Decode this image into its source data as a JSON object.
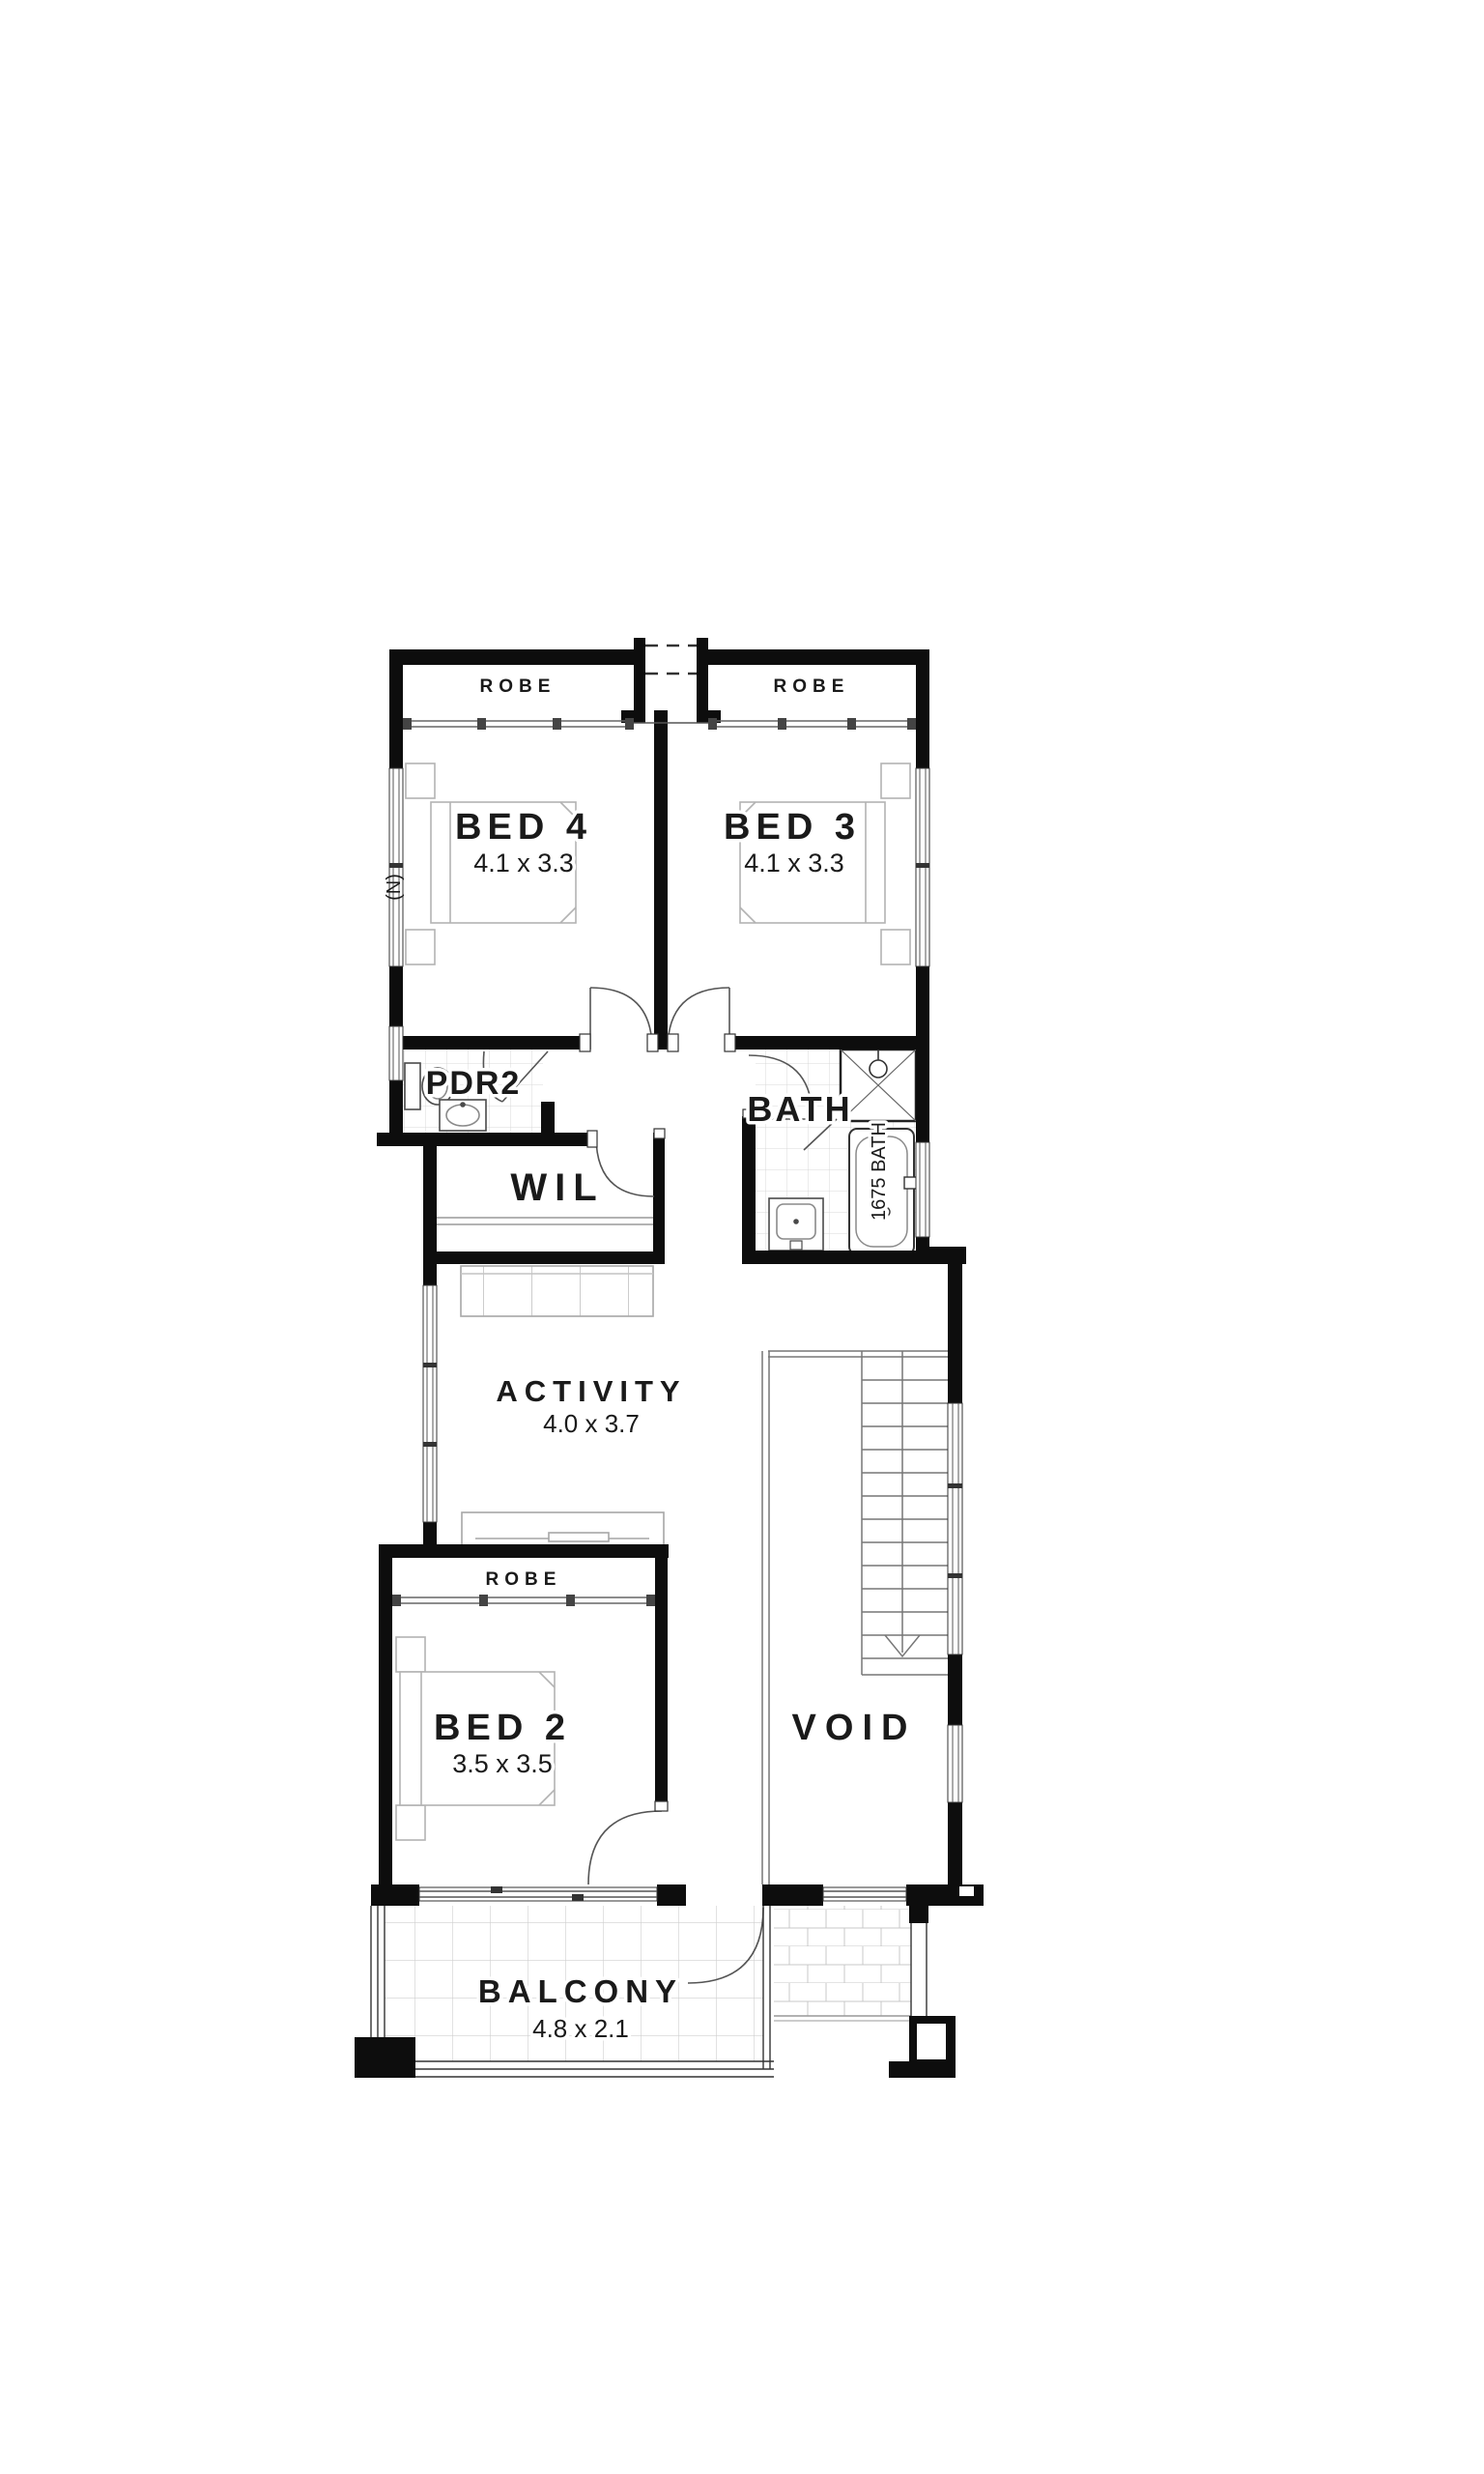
{
  "plan": {
    "rooms": {
      "bed4": {
        "label": "BED 4",
        "dims": "4.1 x 3.3"
      },
      "bed3": {
        "label": "BED 3",
        "dims": "4.1 x 3.3"
      },
      "bed2": {
        "label": "BED 2",
        "dims": "3.5 x 3.5"
      },
      "activity": {
        "label": "ACTIVITY",
        "dims": "4.0 x 3.7"
      },
      "balcony": {
        "label": "BALCONY",
        "dims": "4.8 x 2.1"
      },
      "bath": {
        "label": "BATH"
      },
      "pdr2": {
        "label": "PDR2"
      },
      "wil": {
        "label": "WIL"
      },
      "void": {
        "label": "VOID"
      }
    },
    "robes": [
      "ROBE",
      "ROBE",
      "ROBE"
    ],
    "fixtures": {
      "tub": "1675 BATH"
    },
    "north": "(N)",
    "colors": {
      "wall": "#0d0d0d",
      "furniture_line": "#b3b3b3",
      "tile_line": "#d6d6d6",
      "stair_line": "#777777",
      "text": "#1a1a1a",
      "background": "#ffffff"
    }
  }
}
